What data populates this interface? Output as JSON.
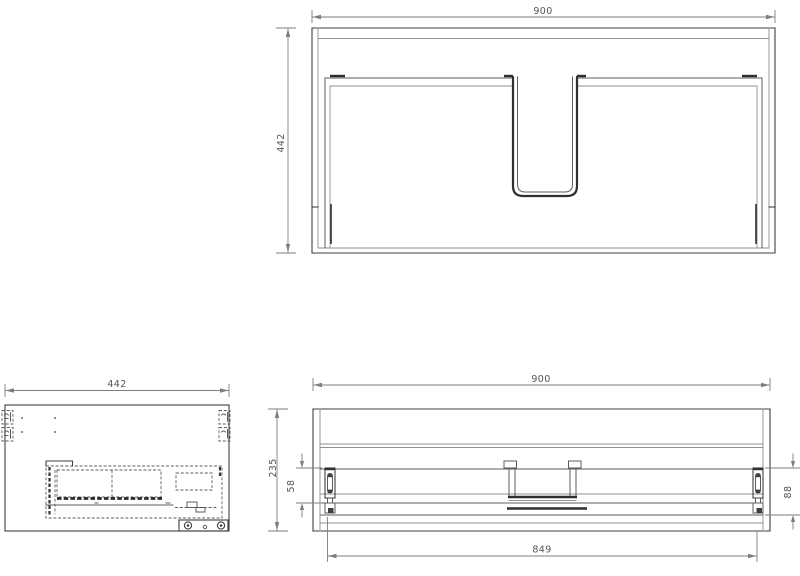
{
  "palette": {
    "background": "#ffffff",
    "object_line": "#3f3f3f",
    "secondary_line": "#8f8f8f",
    "dimension_line": "#7e7e7e",
    "label_text": "#555555"
  },
  "views": {
    "front": {
      "width": "900",
      "height": "442"
    },
    "side": {
      "depth": "442"
    },
    "rear": {
      "width": "900",
      "height": "235",
      "left_bracket": "58",
      "right_bracket": "88",
      "inner_width": "849"
    }
  }
}
